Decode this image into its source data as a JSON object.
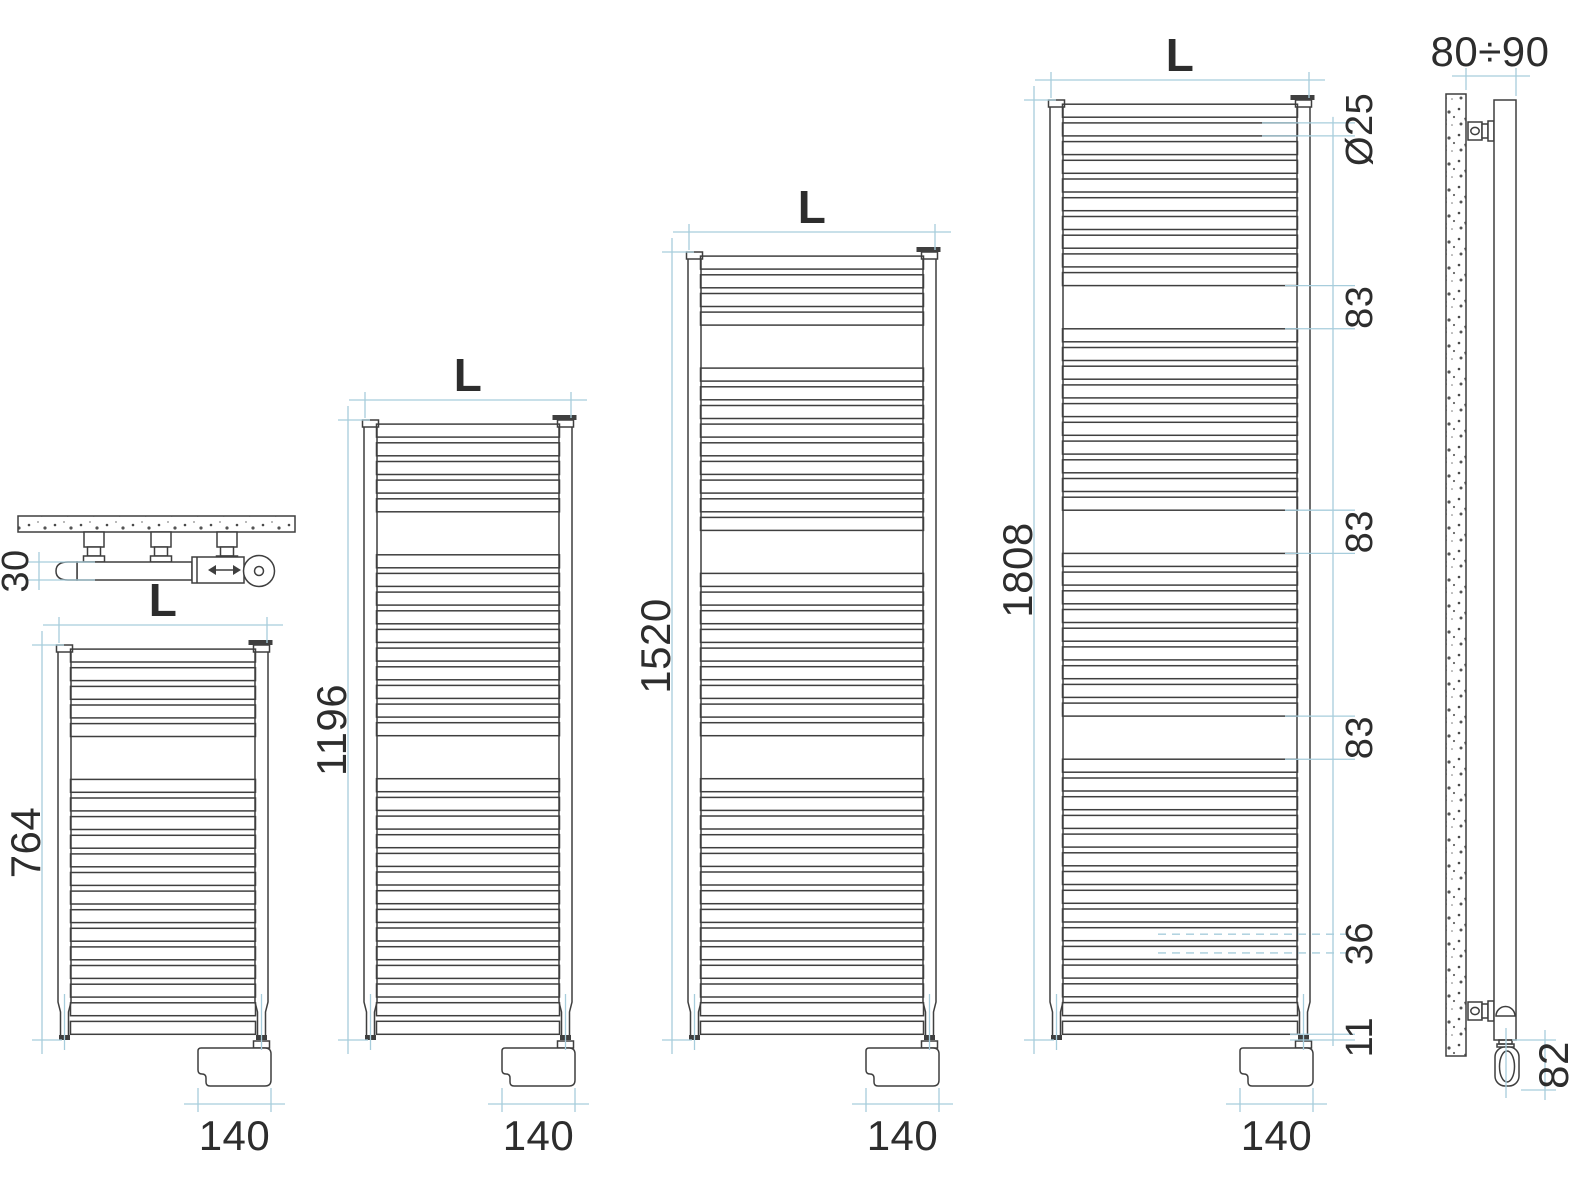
{
  "drawing_labels": {
    "top_view_depth": "30",
    "side_wall_distance": "80÷90",
    "side_element_height": "82"
  },
  "radiators": [
    {
      "height_label": "764",
      "width_label": "L",
      "element_width_label": "140",
      "height_mm": 764,
      "tube_groups": [
        5,
        14
      ]
    },
    {
      "height_label": "1196",
      "width_label": "L",
      "element_width_label": "140",
      "height_mm": 1196,
      "tube_groups": [
        5,
        10,
        14
      ]
    },
    {
      "height_label": "1520",
      "width_label": "L",
      "element_width_label": "140",
      "height_mm": 1520,
      "tube_groups": [
        4,
        9,
        9,
        14
      ]
    },
    {
      "height_label": "1808",
      "width_label": "L",
      "element_width_label": "140",
      "height_mm": 1808,
      "tube_groups": [
        10,
        10,
        9,
        15
      ],
      "detail_labels": [
        "Ø25",
        "83",
        "83",
        "83",
        "36",
        "11"
      ]
    }
  ],
  "model_mm": {
    "tube_diameter": 25,
    "tube_pitch": 36,
    "group_gap": 83,
    "top_margin": 8,
    "bottom_offset": 11,
    "element_width": 140,
    "element_height": 82
  },
  "colors": {
    "line": "#3f3f3f",
    "dim_line": "#a7cddc",
    "label": "#2d2d2d",
    "background": "#ffffff"
  }
}
